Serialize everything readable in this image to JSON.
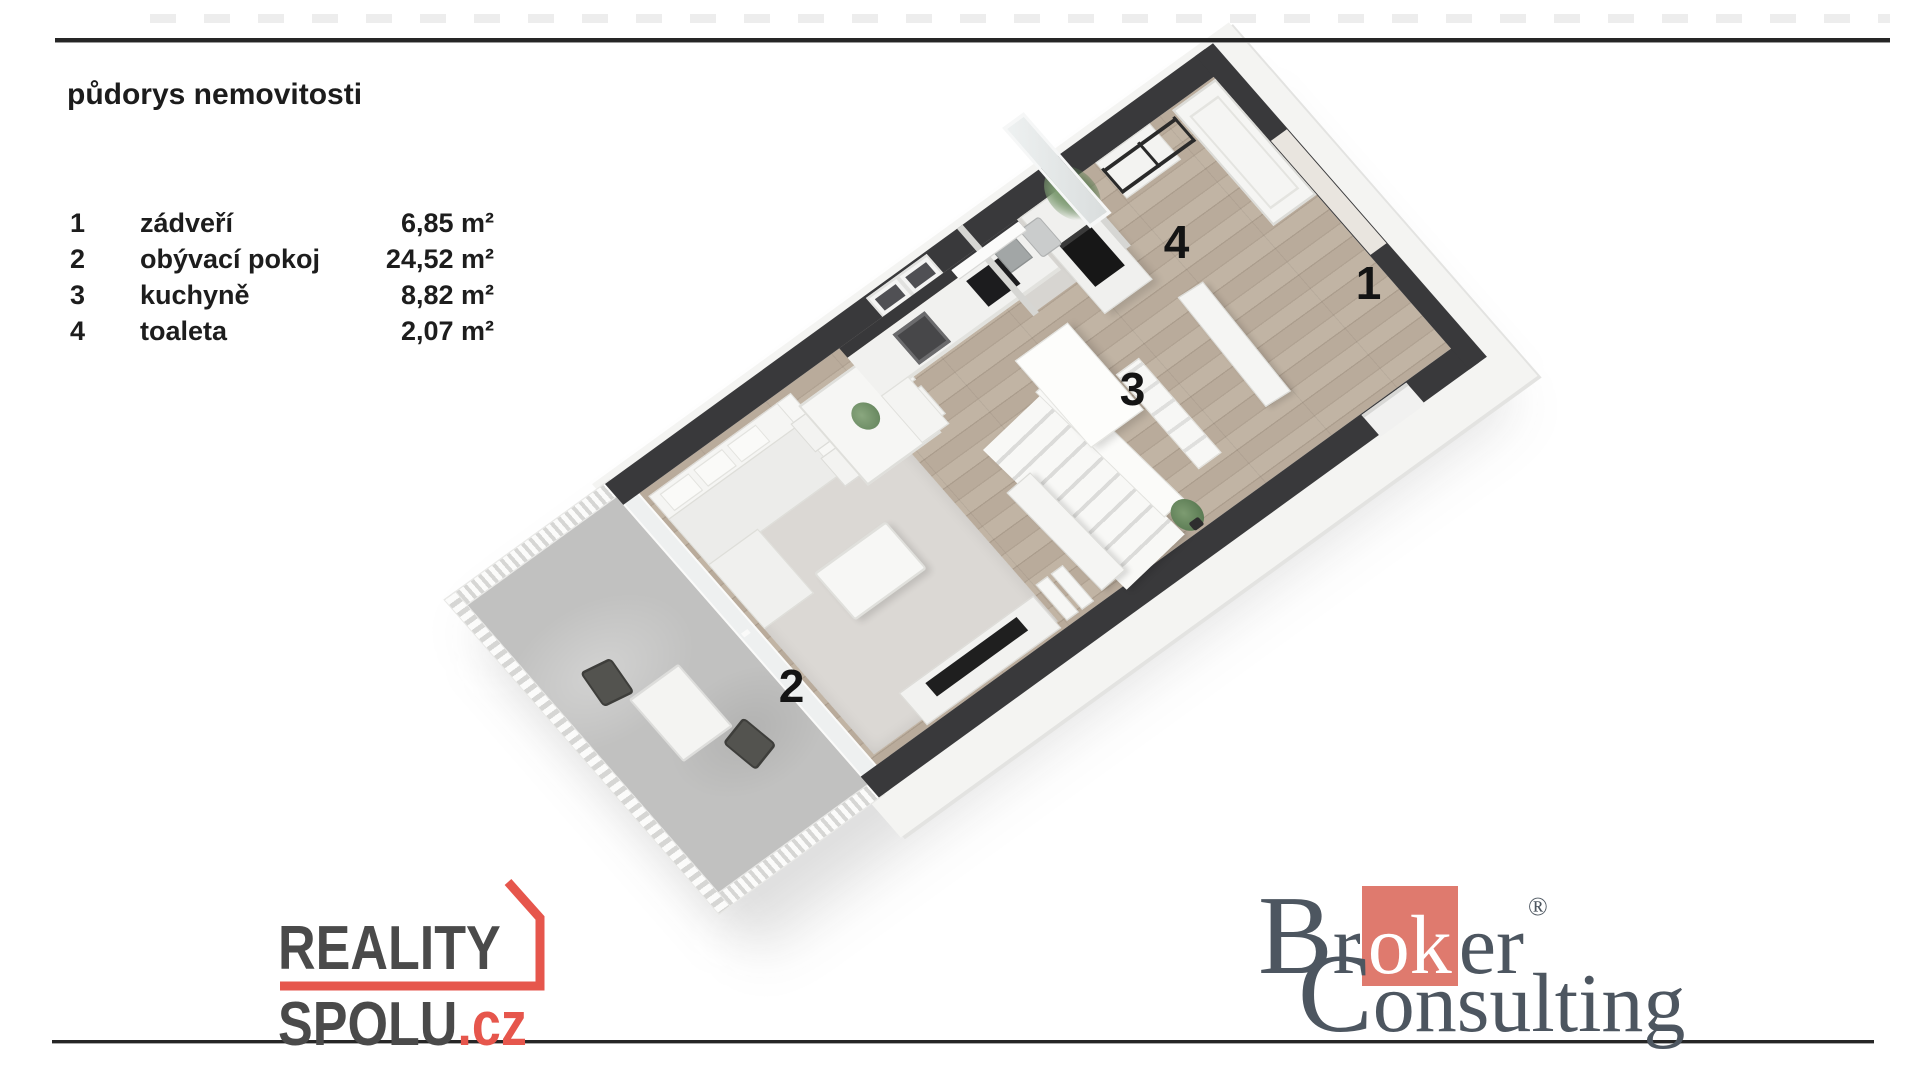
{
  "title": "půdorys nemovitosti",
  "legend": [
    {
      "num": "1",
      "name": "zádveří",
      "area": "6,85 m²"
    },
    {
      "num": "2",
      "name": "obývací pokoj",
      "area": "24,52 m²"
    },
    {
      "num": "3",
      "name": "kuchyně",
      "area": "8,82 m²"
    },
    {
      "num": "4",
      "name": "toaleta",
      "area": "2,07 m²"
    }
  ],
  "plan": {
    "labels": [
      "1",
      "2",
      "3",
      "4"
    ]
  },
  "logo_reality_spolu": {
    "line1": "REALITY",
    "line2": "SPOLU",
    "tld": ".cz",
    "text_color": "#4a4a4a",
    "accent_color": "#e6564c"
  },
  "logo_broker_consulting": {
    "word1_pre": "Br",
    "word1_highlight": "ok",
    "word1_post": "er",
    "registered": "®",
    "word2": "Consulting",
    "text_color": "#4d5660",
    "accent_color": "#df7a6e"
  },
  "colors": {
    "wall_dark": "#39393b",
    "wood_floor": "#b9ab9b",
    "living_rug": "#dbd8d4",
    "balcony_concrete": "#c1c1c0",
    "page_rule": "#262626"
  }
}
